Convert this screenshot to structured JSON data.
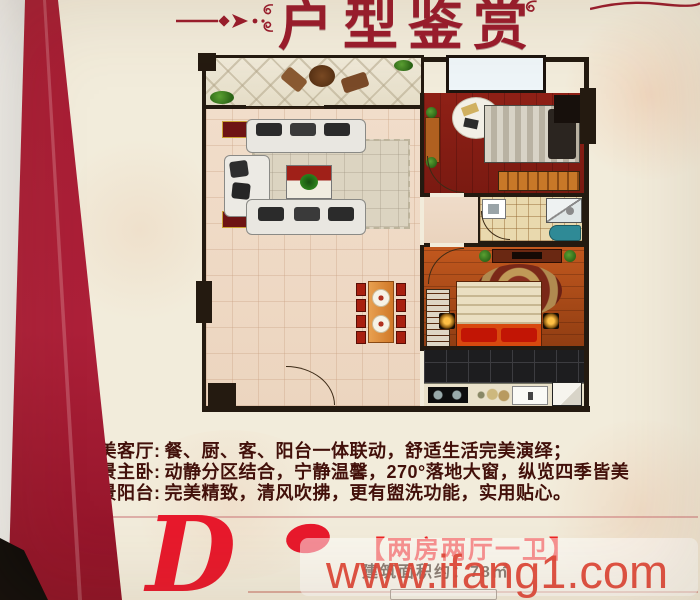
{
  "poster": {
    "title": "户型鉴赏",
    "features": [
      {
        "label": "华美客厅:",
        "text": "餐、厨、客、阳台一体联动，舒适生活完美演绎；"
      },
      {
        "label": "阔景主卧:",
        "text": "动静分区结合，宁静温馨，270°落地大窗，纵览四季皆美"
      },
      {
        "label": "观景阳台:",
        "text": "完美精致，清风吹拂，更有盥洗功能，实用贴心。"
      }
    ],
    "unit": {
      "letter": "D",
      "tag": "【两房两厅一卫】",
      "area": "建筑面积约：78㎡"
    },
    "watermark": "www.ifang1.com",
    "icons": {
      "ornament_left": "dash-arrow-flourish-icon",
      "ornament_swirl": "spiral-flourish-icon",
      "ornament_corner": "corner-flourish-icon",
      "plant": "potted-plant-icon"
    },
    "colors": {
      "title_red": "#9a1b2c",
      "side_band_red": "#a51d33",
      "unit_red": "#e8192c",
      "watermark_red": "#df493a",
      "body_text": "#42100a",
      "poster_background": "#f2ecdb",
      "wall": "#241a10",
      "bedroom2_floor": "#8f2016",
      "master_floor": "#c2581e",
      "living_floor": "#f1ddca"
    }
  }
}
